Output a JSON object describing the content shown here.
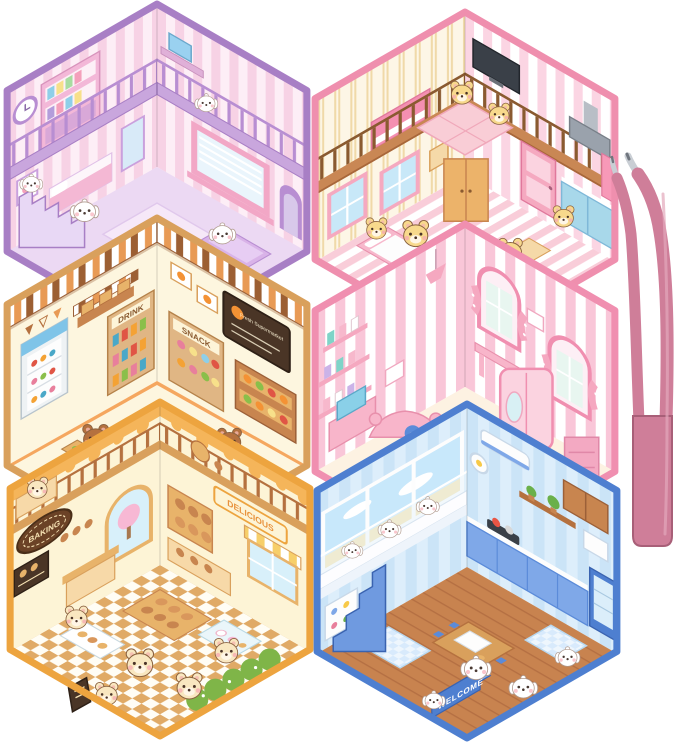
{
  "product": {
    "description": "Six hexagonal 3D cartoon sticker-book room scenes arranged in a honeycomb, with a pink applicator tweezers at right",
    "background": "#ffffff"
  },
  "scenes": [
    {
      "id": "purple-puppy-bedroom",
      "label": "purple two-story puppy bedroom",
      "characters": "white puppies",
      "palette": {
        "border": "#a87fc5",
        "wall_base": "#fdeef6",
        "wall_stripe": "#f7d2e5",
        "floor": "#ecd9f3",
        "accent": "#b88ed2",
        "character": "#ffffff"
      }
    },
    {
      "id": "bear-family-home",
      "label": "pink loft home with yellow bears",
      "characters": "yellow bears",
      "palette": {
        "border": "#ef8fae",
        "wall_left_base": "#fdf6e6",
        "wall_left_stripe": "#f0d9a8",
        "wall_right_base": "#ffffff",
        "wall_right_stripe": "#fbd5e3",
        "wood": "#c98754",
        "floor_a": "#ffffff",
        "floor_b": "#f9cdd9",
        "character": "#f8d98c"
      }
    },
    {
      "id": "bear-supermarket",
      "label": "brown bear supermarket",
      "characters": "brown bears",
      "signs": {
        "drink": "DRINK",
        "snack": "SNACK",
        "board": "Fresh Supermarket"
      },
      "palette": {
        "border": "#d9a05c",
        "wall": "#fdf6df",
        "awning_light": "#ffffff",
        "awning_orange": "#e89a55",
        "awning_dark": "#9c5f33",
        "shelf": "#e0b684",
        "floor": "#f5a75f",
        "character": "#b5713f"
      }
    },
    {
      "id": "pony-bedroom",
      "label": "pink pony bedroom",
      "characters": "toy ponies",
      "palette": {
        "border": "#f08fb0",
        "wall_base": "#ffffff",
        "wall_stripe": "#f9c6d8",
        "accent": "#f5a8c0",
        "floor": "#fdf2e2",
        "character": "#ffffff"
      }
    },
    {
      "id": "bear-bakery",
      "label": "cream bear bakery cafe",
      "characters": "cream bears",
      "signs": {
        "oval": "BAKING",
        "banner": "DELICIOUS"
      },
      "palette": {
        "border": "#eda43f",
        "wall": "#fdf4d6",
        "drip": "#f5b55a",
        "wood": "#e8b36a",
        "floor_a": "#fffdf5",
        "floor_b": "#e0aa66",
        "character": "#f9e7c0"
      }
    },
    {
      "id": "puppy-kitchen-diner",
      "label": "blue puppy kitchen diner",
      "characters": "white puppies",
      "signs": {
        "welcome": "WELCOME"
      },
      "palette": {
        "border": "#4e7fd0",
        "wall_base": "#ddeefb",
        "wall_stripe": "#cbe4f7",
        "accent": "#5b8bd9",
        "floor": "#c8834f",
        "character": "#ffffff"
      }
    }
  ],
  "tweezers": {
    "name": "pink curved-tip tweezers",
    "color": "#cf7e99",
    "edge": "#a85f78",
    "highlight": "#e2a8bb",
    "tip": "#c9ced4",
    "tip_dark": "#70767e"
  }
}
